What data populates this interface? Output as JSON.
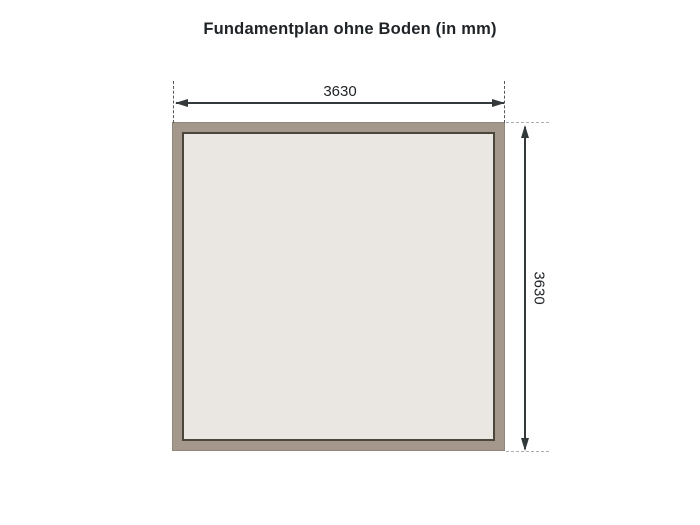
{
  "title": "Fundamentplan ohne Boden (in mm)",
  "diagram": {
    "type": "foundation-plan",
    "width_label": "3630",
    "height_label": "3630",
    "unit": "mm",
    "colors": {
      "background": "#ffffff",
      "frame": "#a3988b",
      "frame_edge": "#90867a",
      "inner_fill": "#eae6e1",
      "inner_border": "#4b463c",
      "dimension_line": "#33383b",
      "extension_dash_dark": "#54585a",
      "extension_dash_light": "#aab0b2",
      "text": "#1e2327"
    }
  }
}
